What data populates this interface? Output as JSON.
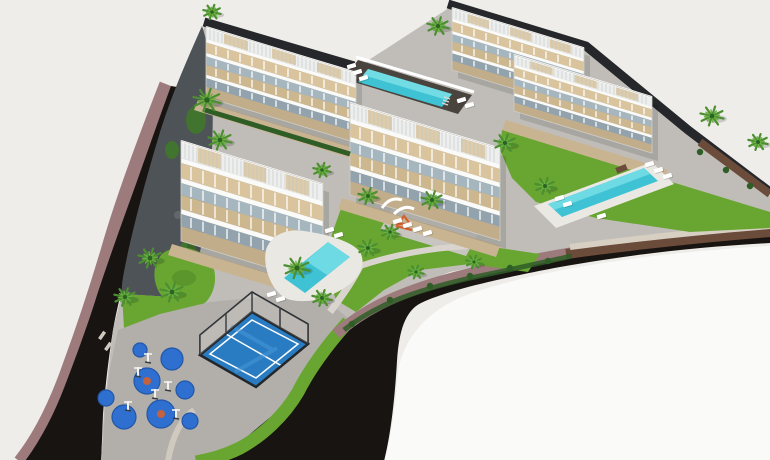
{
  "meta": {
    "title": "aerial-3d-render-residential-complex",
    "description": "Aerial isometric 3D architectural render of a new-build residential development: white terraced apartment blocks with rooftop solariums, three turquoise swimming pools, landscaped palm gardens, a padel court and an outdoor gym playground, enclosed by a curved dark asphalt road with dusty-rose sidewalks on a pale background."
  },
  "palette": {
    "bg": "#eeedea",
    "white_fg": "#fafaf8",
    "sidewalk": "#9d7b7d",
    "road": "#181411",
    "curb": "#cfc9c0",
    "gravel": "#d6cfc2",
    "paving": "#c0bdb8",
    "plaza": "#b2afaa",
    "plaza_light": "#c8c5c0",
    "hillside": "#4e5357",
    "hill_green": "#41742f",
    "rock": "#62676b",
    "lawn": "#68a631",
    "lawn_dark": "#4e8527",
    "hedge": "#2f5d26",
    "stone": "#c9b492",
    "deck_white": "#eae8e3",
    "wall_dark": "#26272b",
    "wall_brown": "#6b4b3a",
    "pergola": "#edefee",
    "slat": "#c2c7c5",
    "bwhite": "#fafaf8",
    "deck1": "#d9c49d",
    "deck2": "#cdb78e",
    "glass1": "#a6b6bf",
    "glass2": "#92a3ae",
    "stone_base": "#c2ad8a",
    "pool_deck": "#49443e",
    "pool1": "#3fc3d4",
    "pool_hi": "#8deaee",
    "padel": "#2a7cc2",
    "padel_hi": "#4598d8",
    "cage": "#23272b",
    "pad": "#2e6fd0",
    "pad_dark": "#2257a8",
    "pad_orange": "#d4602f",
    "equip": "#f2f2f0",
    "palm1": "#2c6323",
    "palm2": "#4c8f31",
    "palm3": "#6ab03f",
    "white": "#ffffff",
    "path_light": "#d9d5ce",
    "sign": "#e9e7e3",
    "shadow": "rgba(0,0,0,0.12)"
  },
  "scene": {
    "slope": 0.305,
    "building_rows": [
      {
        "f": 0.17,
        "c": "pergola",
        "deco": "slats"
      },
      {
        "f": 0.05,
        "c": "bwhite"
      },
      {
        "f": 0.15,
        "c": "deck1",
        "deco": "ticks"
      },
      {
        "f": 0.05,
        "c": "bwhite"
      },
      {
        "f": 0.12,
        "c": "glass1",
        "deco": "ticks"
      },
      {
        "f": 0.14,
        "c": "deck2",
        "deco": "ticks"
      },
      {
        "f": 0.05,
        "c": "bwhite"
      },
      {
        "f": 0.12,
        "c": "glass2",
        "deco": "ticks"
      },
      {
        "f": 0.15,
        "c": "stone_base"
      }
    ],
    "buildings": [
      {
        "name": "block-a1",
        "x": 206,
        "y": 27,
        "len": 150,
        "h": 70
      },
      {
        "name": "block-a2",
        "x": 452,
        "y": 8,
        "len": 132,
        "h": 62
      },
      {
        "name": "block-b",
        "x": 514,
        "y": 55,
        "len": 138,
        "h": 56
      },
      {
        "name": "block-c",
        "x": 350,
        "y": 103,
        "len": 150,
        "h": 92
      },
      {
        "name": "block-d",
        "x": 181,
        "y": 141,
        "len": 142,
        "h": 100
      }
    ],
    "palms": [
      {
        "x": 212,
        "y": 12,
        "s": 9
      },
      {
        "x": 207,
        "y": 100,
        "s": 14
      },
      {
        "x": 220,
        "y": 140,
        "s": 12
      },
      {
        "x": 438,
        "y": 26,
        "s": 11
      },
      {
        "x": 505,
        "y": 143,
        "s": 11
      },
      {
        "x": 712,
        "y": 116,
        "s": 12
      },
      {
        "x": 758,
        "y": 142,
        "s": 10
      },
      {
        "x": 545,
        "y": 186,
        "s": 10
      },
      {
        "x": 432,
        "y": 200,
        "s": 11
      },
      {
        "x": 368,
        "y": 196,
        "s": 10
      },
      {
        "x": 390,
        "y": 232,
        "s": 9
      },
      {
        "x": 368,
        "y": 248,
        "s": 10
      },
      {
        "x": 297,
        "y": 268,
        "s": 13
      },
      {
        "x": 322,
        "y": 298,
        "s": 10
      },
      {
        "x": 150,
        "y": 258,
        "s": 12
      },
      {
        "x": 172,
        "y": 292,
        "s": 12
      },
      {
        "x": 125,
        "y": 297,
        "s": 11
      },
      {
        "x": 322,
        "y": 170,
        "s": 9
      },
      {
        "x": 416,
        "y": 272,
        "s": 8
      },
      {
        "x": 474,
        "y": 262,
        "s": 8
      }
    ],
    "loungers": [
      {
        "x": 352,
        "y": 66
      },
      {
        "x": 358,
        "y": 72
      },
      {
        "x": 364,
        "y": 78
      },
      {
        "x": 462,
        "y": 100
      },
      {
        "x": 470,
        "y": 105
      },
      {
        "x": 560,
        "y": 198
      },
      {
        "x": 568,
        "y": 204
      },
      {
        "x": 650,
        "y": 164
      },
      {
        "x": 659,
        "y": 170
      },
      {
        "x": 668,
        "y": 176
      },
      {
        "x": 602,
        "y": 216
      },
      {
        "x": 272,
        "y": 294
      },
      {
        "x": 281,
        "y": 299
      },
      {
        "x": 330,
        "y": 230
      },
      {
        "x": 339,
        "y": 235
      },
      {
        "x": 398,
        "y": 221
      },
      {
        "x": 408,
        "y": 225
      },
      {
        "x": 418,
        "y": 229
      },
      {
        "x": 428,
        "y": 233
      }
    ],
    "gym_pads": [
      {
        "x": 147,
        "y": 381,
        "r": 13
      },
      {
        "x": 124,
        "y": 417,
        "r": 12
      },
      {
        "x": 161,
        "y": 414,
        "r": 14
      },
      {
        "x": 185,
        "y": 390,
        "r": 9
      },
      {
        "x": 172,
        "y": 359,
        "r": 11
      },
      {
        "x": 106,
        "y": 398,
        "r": 8
      },
      {
        "x": 140,
        "y": 350,
        "r": 7
      },
      {
        "x": 190,
        "y": 421,
        "r": 8
      }
    ],
    "gym_equipment": [
      {
        "x": 138,
        "y": 376
      },
      {
        "x": 155,
        "y": 398
      },
      {
        "x": 128,
        "y": 410
      },
      {
        "x": 168,
        "y": 390
      },
      {
        "x": 148,
        "y": 362
      },
      {
        "x": 176,
        "y": 418
      }
    ],
    "bushes": [
      {
        "x": 352,
        "y": 324
      },
      {
        "x": 390,
        "y": 300
      },
      {
        "x": 430,
        "y": 286
      },
      {
        "x": 470,
        "y": 276
      },
      {
        "x": 510,
        "y": 268
      },
      {
        "x": 548,
        "y": 261
      },
      {
        "x": 700,
        "y": 152
      },
      {
        "x": 726,
        "y": 170
      },
      {
        "x": 750,
        "y": 186
      }
    ]
  }
}
